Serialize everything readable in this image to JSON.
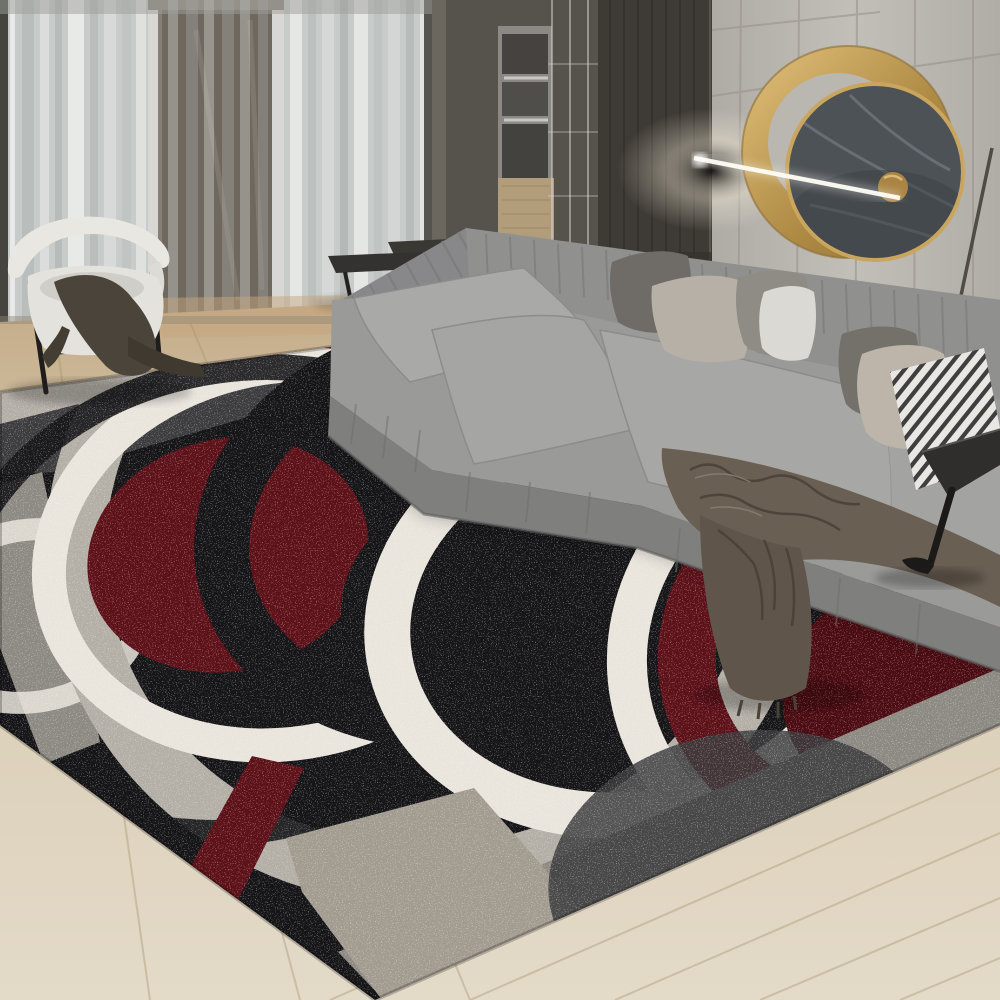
{
  "meta": {
    "domain": "natural-image",
    "subject": "Modern living room with abstract circle-pattern area rug",
    "style": "product lifestyle photograph, no visible text",
    "dimensions": "1000x1000"
  },
  "scene": {
    "background": [
      "sheer curtained floor-to-ceiling windows",
      "glass door opening",
      "dark built-in cabinetry with oven stack",
      "dark wood wall panel",
      "light grooved panel wall"
    ],
    "wall_decor": [
      "gold ring wall mirror with dark marble disc and small gold medallion",
      "horizontal wall-light beam crossing the mirror"
    ],
    "furniture": [
      "white barrel chair with dark cloth draped",
      "two dark nesting coffee tables",
      "gray L-shaped sectional sofa",
      "black angular side table",
      "thin floor lamp pole"
    ],
    "sofa_pillows": [
      "dark gray",
      "beige",
      "gray",
      "white",
      "dark gray",
      "beige",
      "black-white striped"
    ],
    "sofa_throw": "taupe-brown knitted throw draped over right seat",
    "floor": "light oak plank flooring laid diagonally",
    "rug": "abstract pile rug: overlapping rings and discs in black, charcoal, gray, white and deep red with heathered speckle texture"
  },
  "palette": {
    "wall": "#b6b2ac",
    "wall_light": "#c2beb8",
    "wall_groove": "#97938d",
    "curtain_base": "#c7cbc9",
    "curtain_bright": "#eef0ee",
    "curtain_shadow": "#9d9d9a",
    "door_glass": "#867f76",
    "door_inner": "#6f685f",
    "door_frame": "#d8d7d3",
    "window_frame": "#45443f",
    "cabinet_dark": "#56524c",
    "cabinet_stile": "#6b675f",
    "cabinet_panel": "#3e3a35",
    "cabinet_wood": "#b29d7b",
    "appliance": "#8b8885",
    "appliance_dark": "#454240",
    "glass_line": "#d8d7d3",
    "gold": "#c09a58",
    "gold_dark": "#8c6e35",
    "gold_light": "#e2c27d",
    "marble": "#4d5257",
    "marble_streak": "#7e868c",
    "beam": "#fffdf6",
    "floor_top": "#c3ab87",
    "floor_mid": "#d8cbb2",
    "floor_bottom": "#e3dac8",
    "floor_seam": "#a8946f",
    "floor_warm": "#c5a67e",
    "sofa": "#9a9a99",
    "sofa_light": "#a9a9a8",
    "sofa_back": "#90908f",
    "sofa_back_left": "#88888a",
    "sofa_front": "#7f7f7e",
    "sofa_pleat": "#7c7c7b",
    "pillow_dark": "#6f6c67",
    "pillow_dark2": "#74706a",
    "pillow_beige": "#b7b0a6",
    "pillow_beige2": "#bdb5aa",
    "pillow_gray": "#8f8b85",
    "pillow_white": "#dbd9d4",
    "stripe_dark": "#2d2d2d",
    "stripe_light": "#e8e7e4",
    "throw": "#6a5f53",
    "throw_shade": "#5f554a",
    "throw_dark": "#484136",
    "chair_white": "#e9e7e2",
    "chair_seat": "#e4e2dd",
    "chair_shade": "#cbc9c4",
    "chair_cloth": "#4b443a",
    "chair_cloth_dark": "#3f3930",
    "chair_frame": "#1f1e1c",
    "table_top": "#343230",
    "table_top2": "#3a3835",
    "table_leg": "#232220",
    "side_table": "#2f2e2c",
    "lamp_pole": "#45413b",
    "rug_black": "#161619",
    "rug_charcoal": "#3d3d3f",
    "rug_dim": "#4e4c49",
    "rug_gray": "#8d8983",
    "rug_light": "#b3aea6",
    "rug_beige": "#a29b90",
    "rug_white": "#e9e5dd",
    "rug_red": "#5d1119",
    "rug_red_deep": "#4c0c13",
    "shadow": "#000000"
  }
}
